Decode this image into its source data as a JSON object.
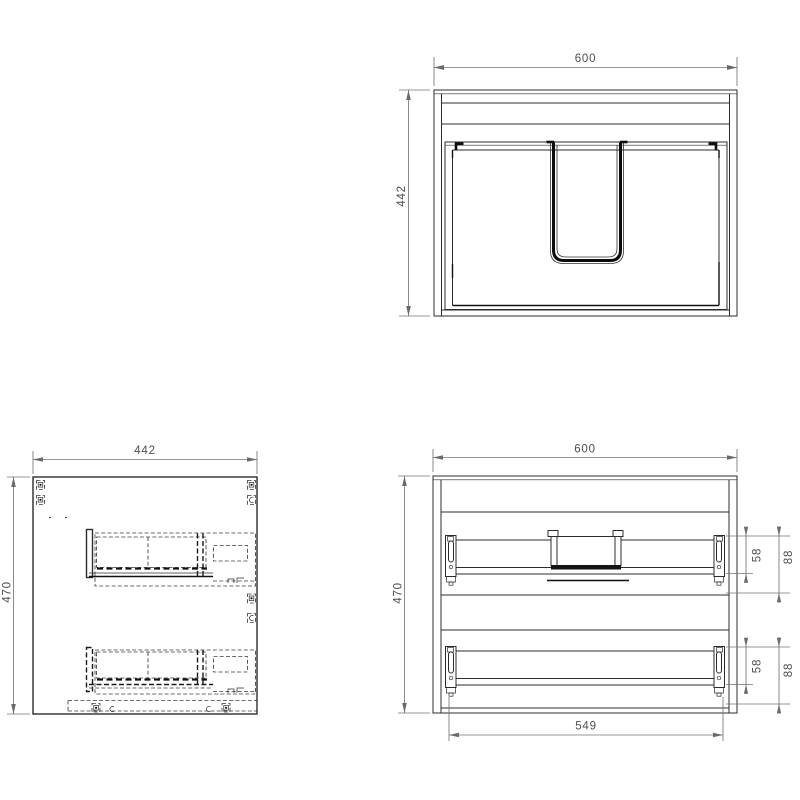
{
  "drawing": {
    "background_color": "#ffffff",
    "line_color": "#2c2c2c",
    "dimension_color": "#6a6a6a",
    "views": {
      "front": {
        "width": "600",
        "height": "442"
      },
      "side": {
        "width": "442",
        "height": "470"
      },
      "internal_front": {
        "width": "600",
        "height": "470",
        "rail_span": "549",
        "rail_top_offset": "58",
        "rail_bottom_offset": "88"
      }
    }
  }
}
